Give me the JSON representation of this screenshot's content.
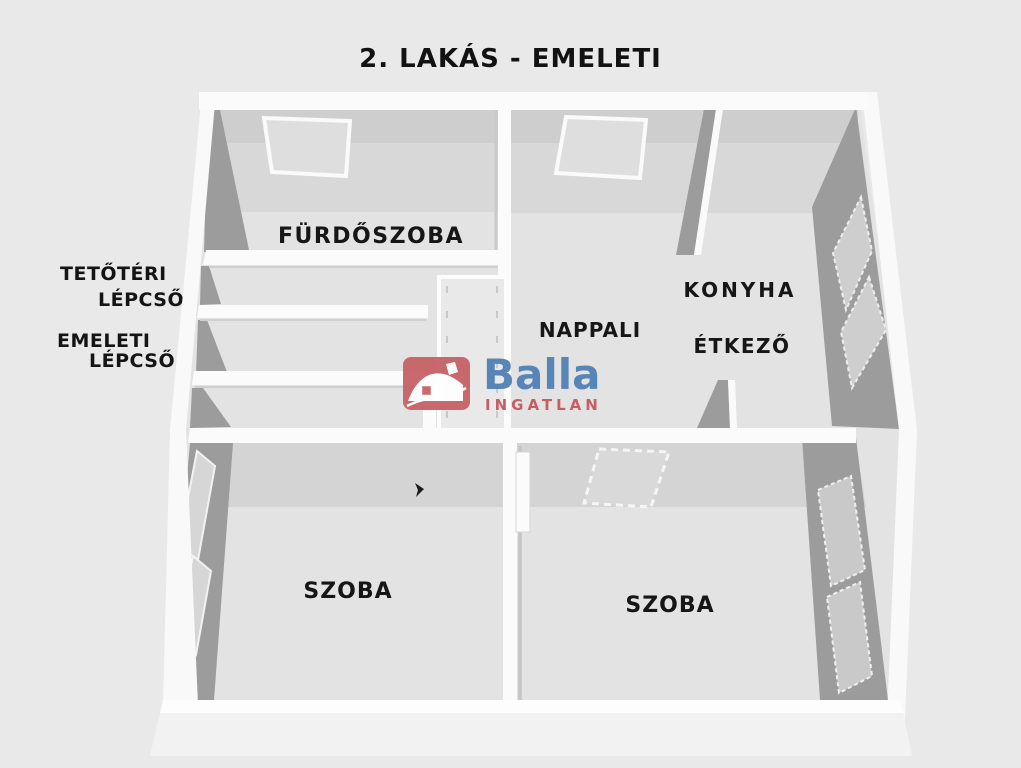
{
  "title": "2. LAKÁS - EMELETI",
  "plan": {
    "rooms": {
      "bathroom": "FÜRDŐSZOBA",
      "living_room": "NAPPALI",
      "kitchen": "KONYHA",
      "dining": "ÉTKEZŐ",
      "room_left": "SZOBA",
      "room_right": "SZOBA"
    },
    "stair_annotations": {
      "attic_stairs_line1": "TETŐTÉRI",
      "attic_stairs_line2": "LÉPCSŐ",
      "floor_stairs_line1": "EMELETI",
      "floor_stairs_line2": "LÉPCSŐ"
    }
  },
  "watermark": {
    "brand": "Balla",
    "tagline": "INGATLAN",
    "brand_color": "#4d7eb4",
    "tagline_color": "#c4545a",
    "icon": "house-icon",
    "icon_color": "#c55f63"
  }
}
